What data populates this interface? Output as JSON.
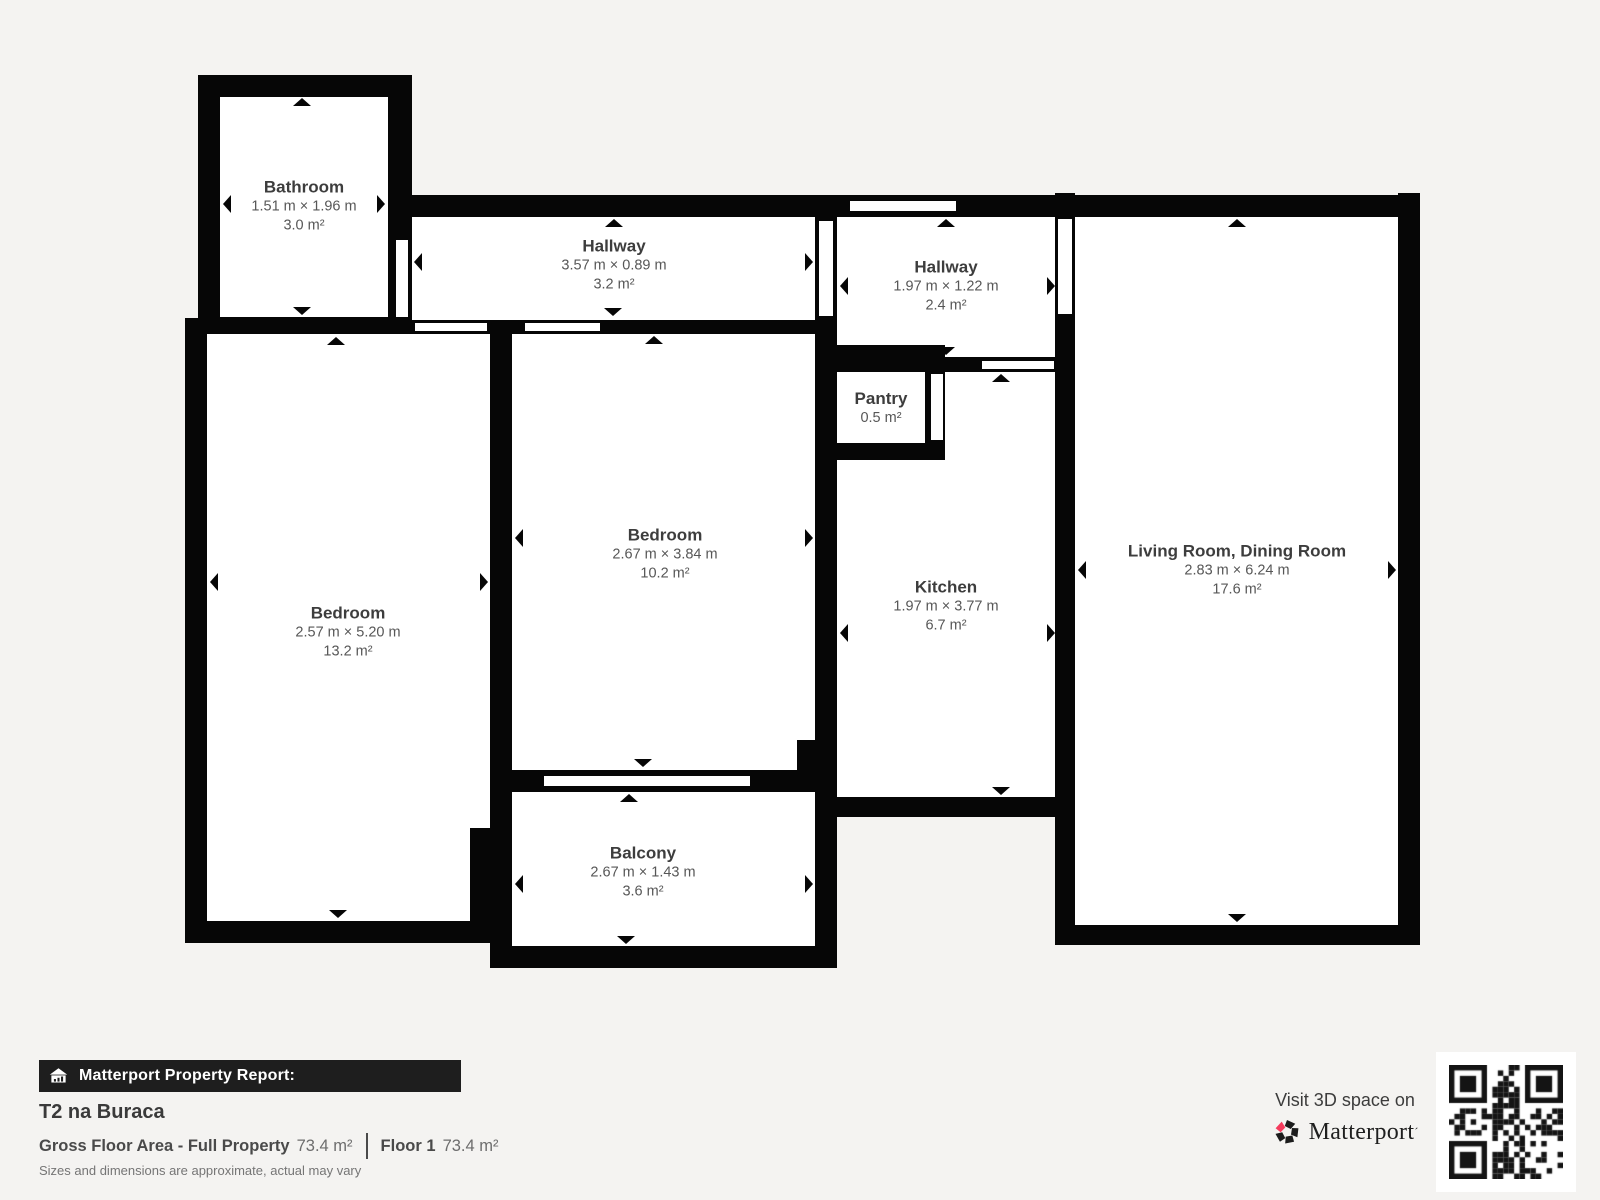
{
  "plan": {
    "rooms": [
      {
        "id": "bathroom",
        "name": "Bathroom",
        "dims": "1.51 m × 1.96 m",
        "area": "3.0 m²"
      },
      {
        "id": "hallway-1",
        "name": "Hallway",
        "dims": "3.57 m × 0.89 m",
        "area": "3.2 m²"
      },
      {
        "id": "hallway-2",
        "name": "Hallway",
        "dims": "1.97 m × 1.22 m",
        "area": "2.4 m²"
      },
      {
        "id": "pantry",
        "name": "Pantry",
        "dims": "",
        "area": "0.5 m²"
      },
      {
        "id": "bedroom-center",
        "name": "Bedroom",
        "dims": "2.67 m × 3.84 m",
        "area": "10.2 m²"
      },
      {
        "id": "bedroom-left",
        "name": "Bedroom",
        "dims": "2.57 m × 5.20 m",
        "area": "13.2 m²"
      },
      {
        "id": "kitchen",
        "name": "Kitchen",
        "dims": "1.97 m × 3.77 m",
        "area": "6.7 m²"
      },
      {
        "id": "living-dining",
        "name": "Living Room, Dining Room",
        "dims": "2.83 m × 6.24 m",
        "area": "17.6 m²"
      },
      {
        "id": "balcony",
        "name": "Balcony",
        "dims": "2.67 m × 1.43 m",
        "area": "3.6 m²"
      }
    ]
  },
  "footer": {
    "report_label": "Matterport Property Report:",
    "property_title": "T2 na Buraca",
    "gross_floor_area_label": "Gross Floor Area - Full Property",
    "gross_floor_area_value": "73.4 m²",
    "floor_label": "Floor 1",
    "floor_value": "73.4 m²",
    "disclaimer": "Sizes and dimensions are approximate, actual may vary"
  },
  "promo": {
    "visit_text": "Visit 3D space on",
    "brand": "Matterport",
    "trademark_mark": "´"
  },
  "icons": {
    "banner_icon": "house-report-icon",
    "brand_icon": "matterport-pinwheel-icon",
    "qr": "qr-code"
  },
  "colors": {
    "background": "#f4f3f1",
    "wall": "#060606",
    "room_fill": "#ffffff",
    "banner": "#1e1e1e",
    "accent_pink": "#f43a5c",
    "room_name_text": "#3d3d3d",
    "room_dim_text": "#575757"
  }
}
